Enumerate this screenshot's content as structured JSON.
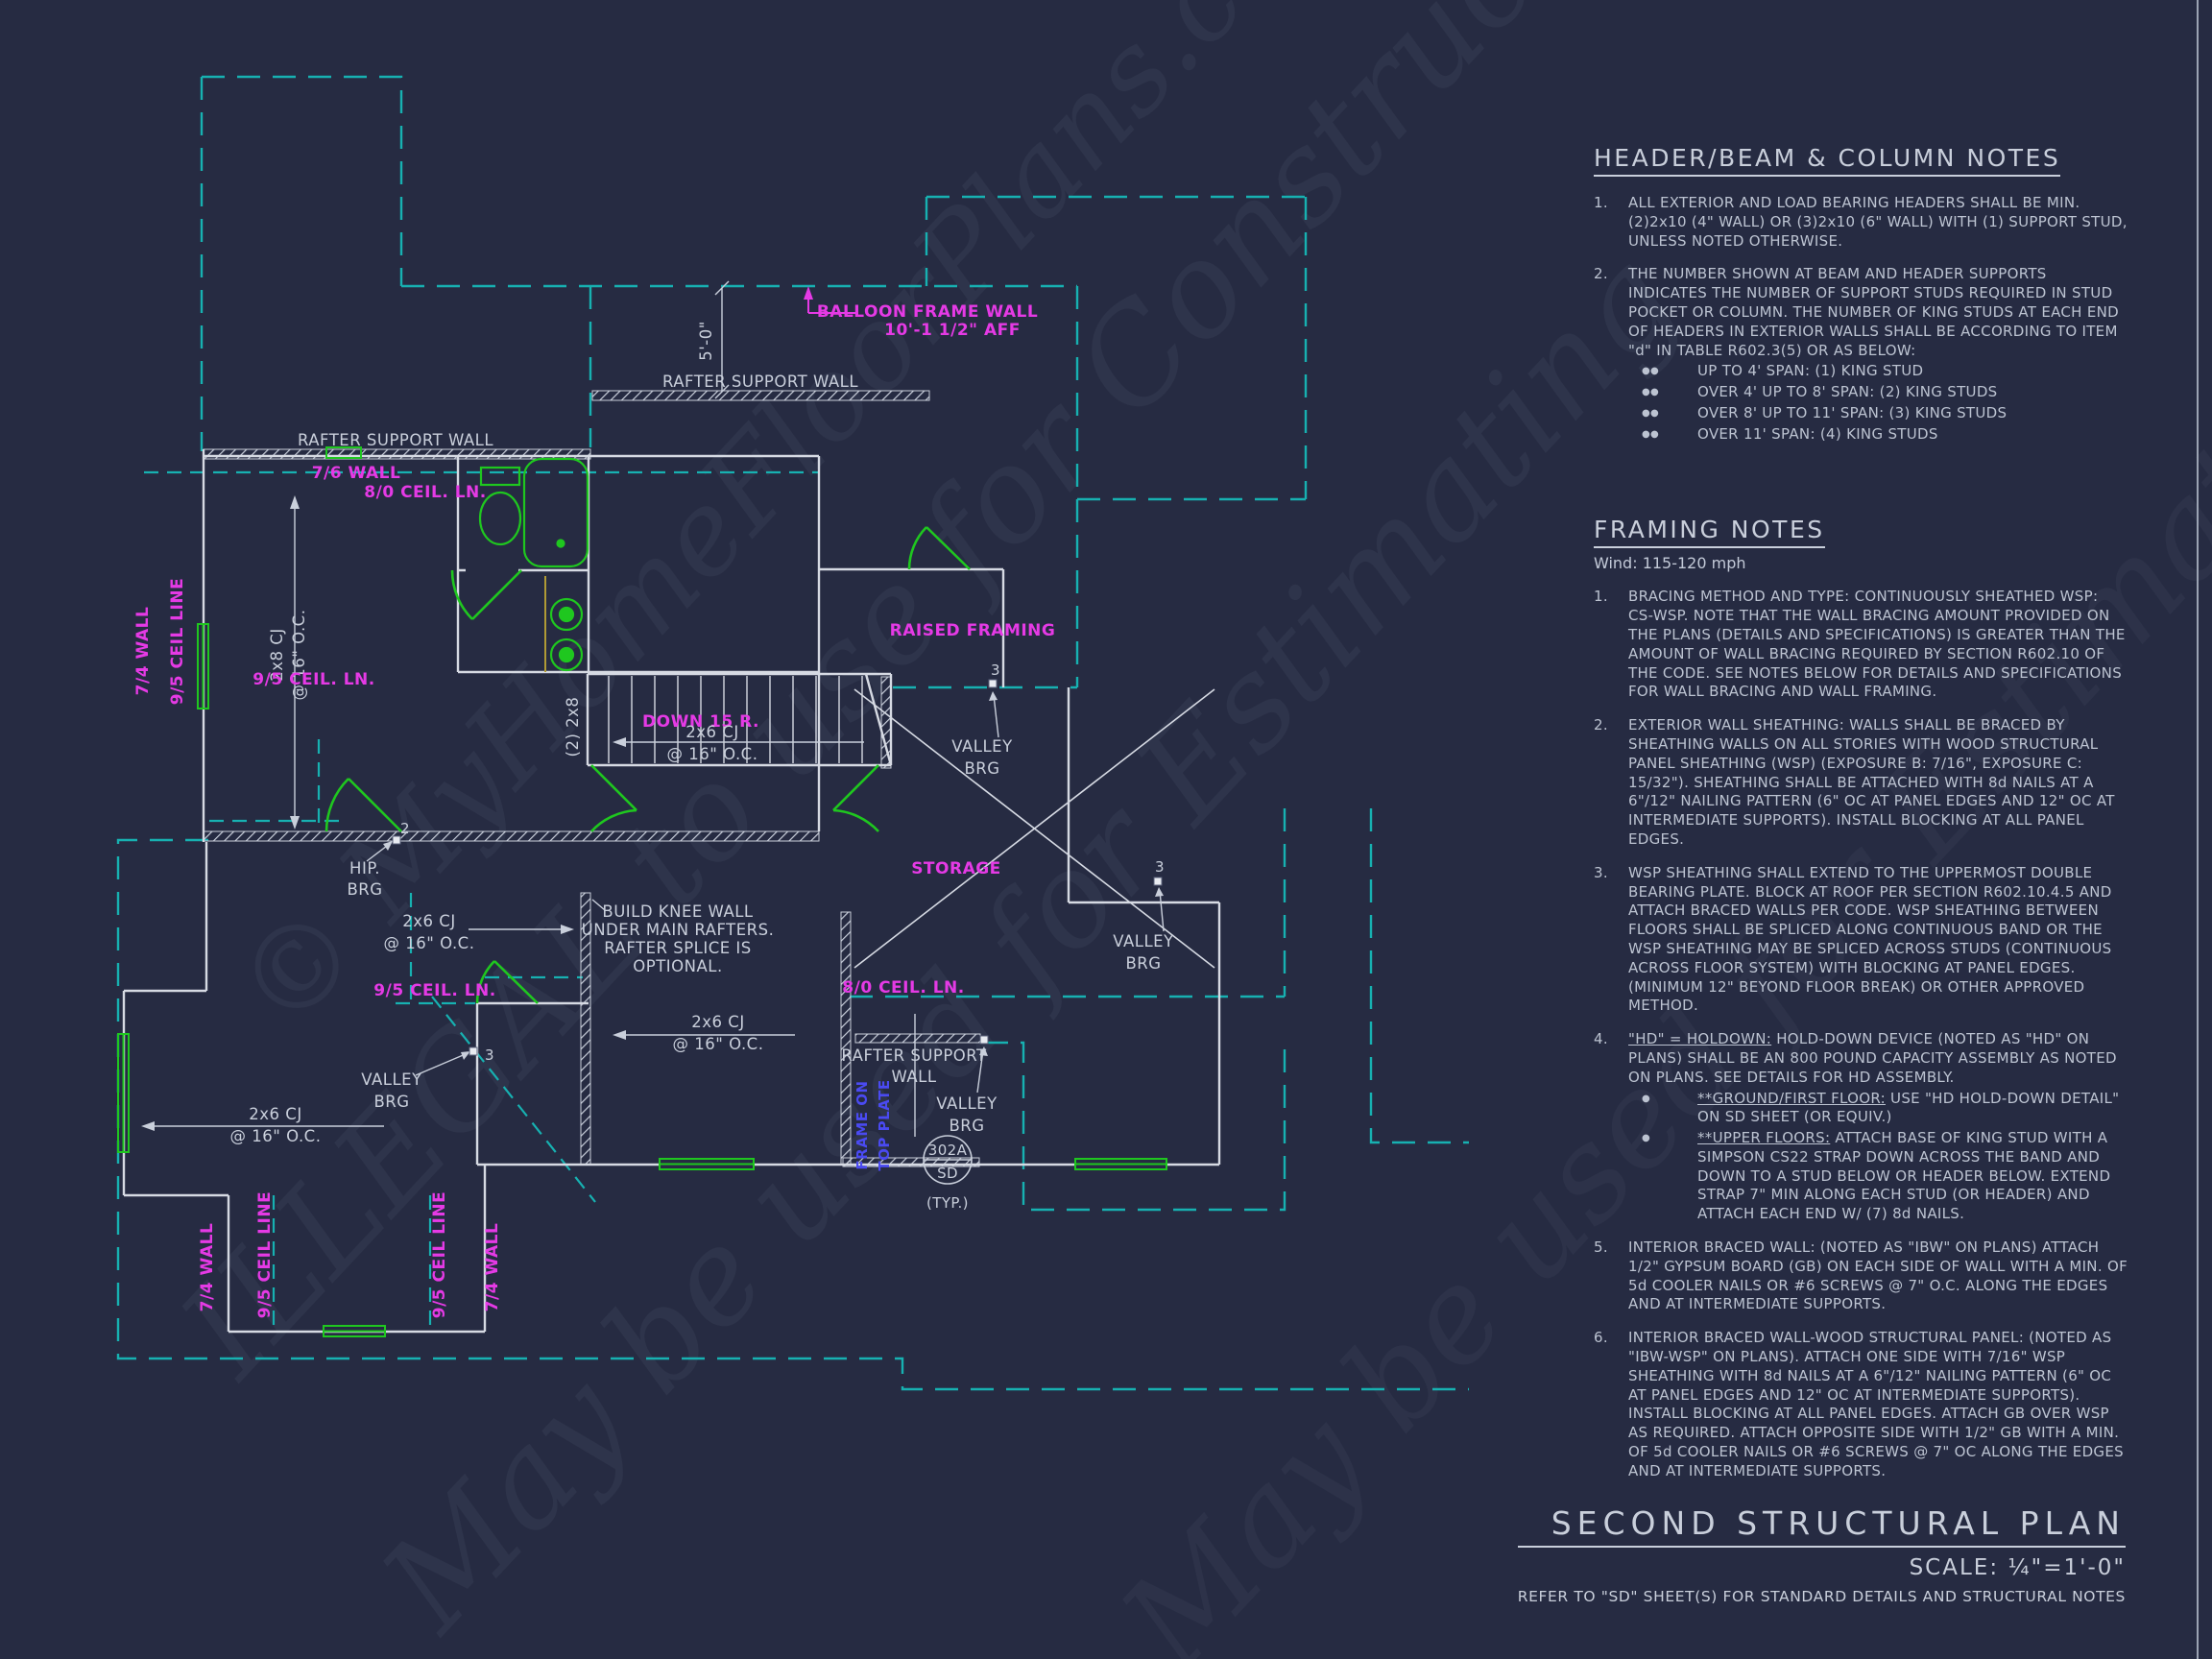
{
  "colors": {
    "background": "#262b42",
    "line": "#c9cfdb",
    "cyan": "#17b1b1",
    "magenta": "#e53ae5",
    "green": "#1fc71f",
    "blue": "#4a4af2",
    "yellow": "#b09a35"
  },
  "watermarks": {
    "w1": "© MyHomeFloorPlans.com",
    "w2": "ILLEGAL to use for Construction",
    "w3": "May be used for Estimating",
    "w4": "May be used for Estimating"
  },
  "title_block": {
    "title": "SECOND STRUCTURAL PLAN",
    "scale": "SCALE: ¼\"=1'-0\"",
    "note": "REFER TO \"SD\" SHEET(S) FOR STANDARD DETAILS AND STRUCTURAL NOTES"
  },
  "header_notes": {
    "title": "HEADER/BEAM & COLUMN NOTES",
    "items": [
      {
        "n": "1.",
        "text": "ALL EXTERIOR AND LOAD BEARING HEADERS SHALL BE MIN. (2)2x10 (4\" WALL) OR (3)2x10 (6\" WALL) WITH (1) SUPPORT STUD, UNLESS NOTED OTHERWISE.",
        "bullet_glyph": "",
        "bullets": []
      },
      {
        "n": "2.",
        "text": "THE NUMBER SHOWN AT BEAM AND HEADER SUPPORTS INDICATES THE NUMBER OF SUPPORT STUDS REQUIRED IN STUD POCKET OR COLUMN. THE NUMBER OF KING STUDS AT EACH END OF HEADERS IN EXTERIOR WALLS SHALL BE ACCORDING TO ITEM \"d\" IN TABLE R602.3(5) OR AS BELOW:",
        "bullet_glyph": "●●",
        "bullets": [
          {
            "lead": "",
            "text": "UP TO 4' SPAN: (1) KING STUD"
          },
          {
            "lead": "",
            "text": "OVER 4' UP TO 8' SPAN: (2) KING STUDS"
          },
          {
            "lead": "",
            "text": "OVER 8' UP TO 11' SPAN: (3) KING STUDS"
          },
          {
            "lead": "",
            "text": "OVER 11' SPAN: (4) KING STUDS"
          }
        ]
      }
    ]
  },
  "framing_notes": {
    "title": "FRAMING NOTES",
    "wind": "Wind: 115-120 mph",
    "items": [
      {
        "n": "1.",
        "text": "BRACING METHOD AND TYPE: CONTINUOUSLY SHEATHED WSP: CS-WSP. NOTE THAT THE WALL BRACING AMOUNT PROVIDED ON THE PLANS (DETAILS AND SPECIFICATIONS) IS GREATER THAN THE AMOUNT OF WALL BRACING REQUIRED BY SECTION R602.10 OF THE CODE. SEE NOTES BELOW FOR DETAILS AND SPECIFICATIONS FOR WALL BRACING AND WALL FRAMING.",
        "bullet_glyph": "",
        "bullets": []
      },
      {
        "n": "2.",
        "text": "EXTERIOR WALL SHEATHING: WALLS SHALL BE BRACED BY SHEATHING WALLS ON ALL STORIES WITH WOOD STRUCTURAL PANEL SHEATHING (WSP) (EXPOSURE B: 7/16\", EXPOSURE C: 15/32\"). SHEATHING SHALL BE ATTACHED WITH 8d NAILS AT A 6\"/12\" NAILING PATTERN (6\" OC AT PANEL EDGES AND 12\" OC AT INTERMEDIATE SUPPORTS). INSTALL BLOCKING AT ALL PANEL EDGES.",
        "bullet_glyph": "",
        "bullets": []
      },
      {
        "n": "3.",
        "text": "WSP SHEATHING SHALL EXTEND TO THE UPPERMOST DOUBLE BEARING PLATE. BLOCK AT ROOF PER SECTION R602.10.4.5 AND ATTACH BRACED WALLS PER CODE. WSP SHEATHING BETWEEN FLOORS SHALL BE SPLICED ALONG CONTINUOUS BAND OR THE WSP SHEATHING MAY BE SPLICED ACROSS STUDS (CONTINUOUS ACROSS FLOOR SYSTEM) WITH BLOCKING AT PANEL EDGES. (MINIMUM 12\" BEYOND FLOOR BREAK) OR OTHER APPROVED METHOD.",
        "bullet_glyph": "",
        "bullets": []
      },
      {
        "n": "4.",
        "lead": "\"HD\" = HOLDOWN:",
        "text": " HOLD-DOWN DEVICE (NOTED AS \"HD\" ON PLANS) SHALL BE AN 800 POUND CAPACITY ASSEMBLY AS NOTED ON PLANS. SEE DETAILS FOR HD ASSEMBLY.",
        "bullet_glyph": "●",
        "bullets": [
          {
            "lead": "**GROUND/FIRST FLOOR:",
            "text": "  USE \"HD HOLD-DOWN DETAIL\" ON SD SHEET (OR EQUIV.)"
          },
          {
            "lead": "**UPPER FLOORS:",
            "text": " ATTACH BASE OF KING STUD WITH A SIMPSON CS22 STRAP DOWN ACROSS THE BAND AND DOWN TO A STUD BELOW OR HEADER BELOW.  EXTEND STRAP 7\" MIN ALONG EACH STUD (OR HEADER) AND ATTACH EACH END W/ (7) 8d NAILS."
          }
        ]
      },
      {
        "n": "5.",
        "text": "INTERIOR BRACED WALL: (NOTED AS \"IBW\" ON PLANS) ATTACH 1/2\" GYPSUM BOARD (GB) ON EACH SIDE OF WALL WITH A MIN. OF 5d COOLER NAILS OR #6 SCREWS @ 7\" O.C. ALONG THE EDGES AND AT INTERMEDIATE SUPPORTS.",
        "bullet_glyph": "",
        "bullets": []
      },
      {
        "n": "6.",
        "text": "INTERIOR BRACED WALL-WOOD STRUCTURAL PANEL: (NOTED AS \"IBW-WSP\" ON PLANS). ATTACH ONE SIDE WITH 7/16\" WSP SHEATHING WITH 8d NAILS AT A 6\"/12\" NAILING PATTERN (6\" OC AT PANEL EDGES AND 12\" OC AT INTERMEDIATE SUPPORTS). INSTALL BLOCKING AT ALL PANEL EDGES. ATTACH GB OVER WSP AS REQUIRED. ATTACH OPPOSITE SIDE WITH 1/2\" GB WITH A MIN. OF 5d COOLER NAILS OR #6 SCREWS @ 7\" OC ALONG THE EDGES AND AT INTERMEDIATE SUPPORTS.",
        "bullet_glyph": "",
        "bullets": []
      }
    ]
  },
  "plan": {
    "labels": {
      "rafter_wall": "RAFTER SUPPORT WALL",
      "rafter_wall_a": "RAFTER SUPPORT",
      "rafter_wall_b": "WALL",
      "balloon1": "BALLOON FRAME WALL",
      "balloon2": "10'-1 1/2\" AFF",
      "dim_5_0": "5'-0\"",
      "wall_7_6": "7/6 WALL",
      "ceil_8_0": "8/0 CEIL. LN.",
      "ceil_9_5": "9/5 CEIL. LN.",
      "ceil_line_9_5": "9/5 CEIL LINE",
      "wall_7_4": "7/4 WALL",
      "cj_2x8": "2x8 CJ",
      "cj_2x6": "2x6 CJ",
      "oc_16": "@ 16\" O.C.",
      "two_2x8": "(2) 2x8",
      "down15": "DOWN 15 R.",
      "raised": "RAISED FRAMING",
      "storage": "STORAGE",
      "valley": "VALLEY",
      "brg": "BRG",
      "hip": "HIP.",
      "knee1": "BUILD KNEE WALL",
      "knee2": "UNDER MAIN RAFTERS.",
      "knee3": "RAFTER SPLICE IS",
      "knee4": "OPTIONAL.",
      "frame_on": "FRAME ON",
      "top_plate": "TOP PLATE",
      "d302a": "302A",
      "sd": "SD",
      "typ": "(TYP.)",
      "m2": "2",
      "m3": "3"
    }
  }
}
